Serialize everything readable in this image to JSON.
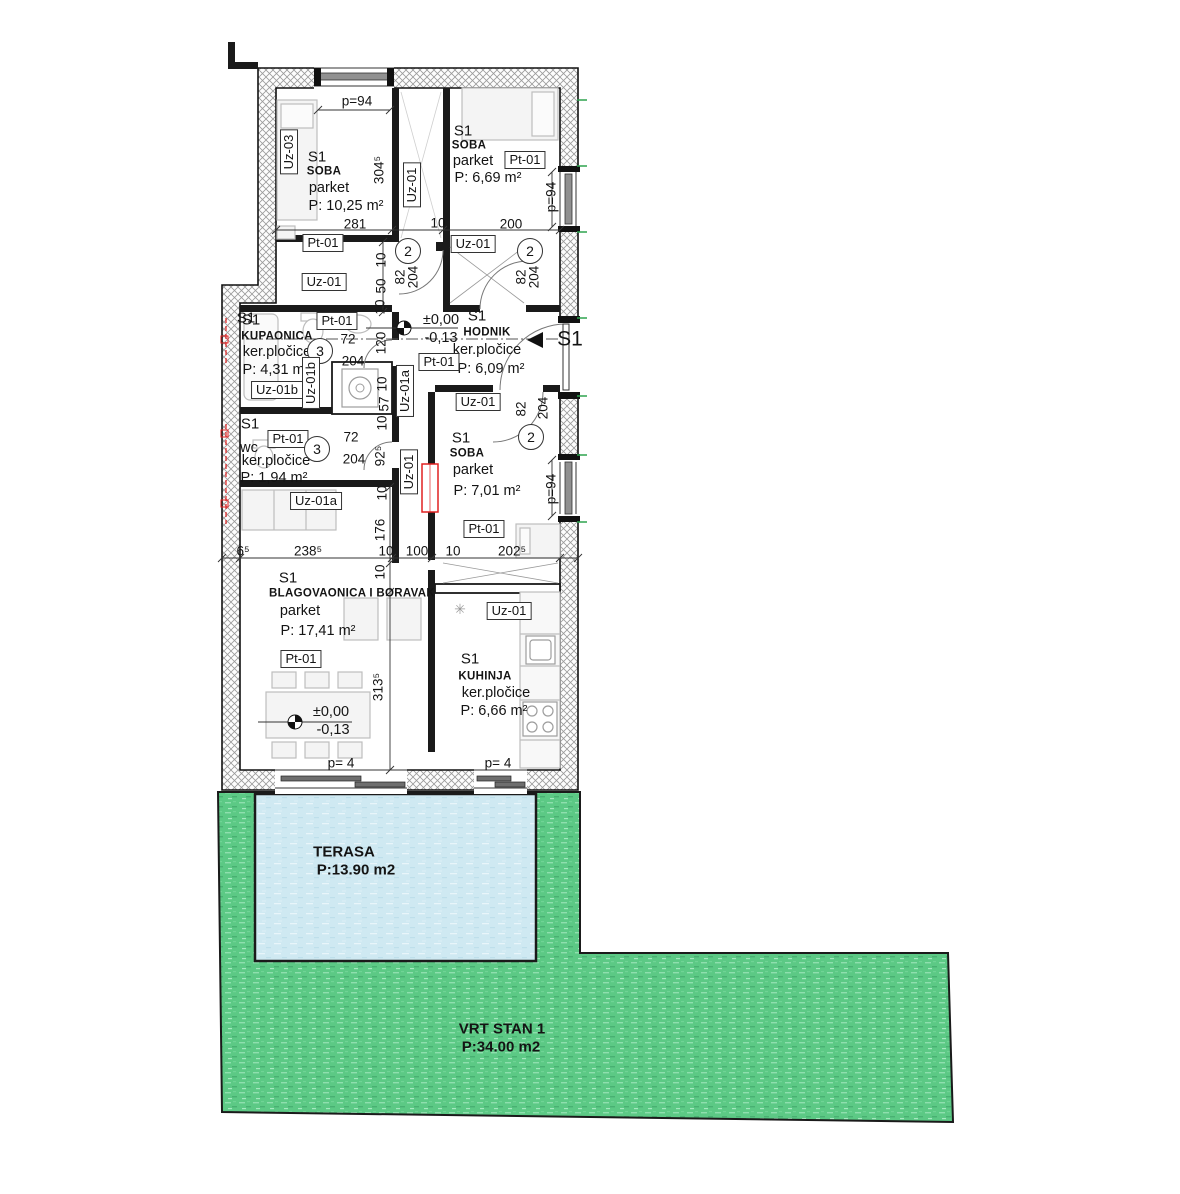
{
  "plan": {
    "drawing_title": "STAN 1 floor plan",
    "colors": {
      "garden": "#5cc985",
      "terrace": "#cfe9f2",
      "wall": "#141414",
      "accent_red": "#e02020",
      "accent_green": "#2ea44f"
    },
    "outdoor": {
      "terrace": {
        "name": "TERASA",
        "area": "P:13.90 m2"
      },
      "garden": {
        "name": "VRT STAN 1",
        "area": "P:34.00 m2"
      }
    },
    "labels": [
      {
        "n": "dim-p94-top",
        "t": "p=94",
        "x": 357,
        "y": 101,
        "c": "dim"
      },
      {
        "n": "tag-uz03",
        "t": "Uz-03",
        "x": 289,
        "y": 152,
        "c": "tag v"
      },
      {
        "n": "room1-id",
        "t": "S1",
        "x": 317,
        "y": 157,
        "c": "rid"
      },
      {
        "n": "room1-name",
        "t": "SOBA",
        "x": 324,
        "y": 172,
        "c": "rname"
      },
      {
        "n": "room1-floor",
        "t": "parket",
        "x": 329,
        "y": 188,
        "c": "rsub"
      },
      {
        "n": "room1-area",
        "t": "P: 10,25 m²",
        "x": 346,
        "y": 206,
        "c": "area"
      },
      {
        "n": "dim-304",
        "t": "304⁵",
        "x": 379,
        "y": 170,
        "c": "dim v"
      },
      {
        "n": "dim-281",
        "t": "281",
        "x": 355,
        "y": 224,
        "c": "dim"
      },
      {
        "n": "tag-pt01-a",
        "t": "Pt-01",
        "x": 323,
        "y": 243,
        "c": "tag"
      },
      {
        "n": "tag-uz01-a",
        "t": "Uz-01",
        "x": 324,
        "y": 282,
        "c": "tag"
      },
      {
        "n": "tag-uz01-closet",
        "t": "Uz-01",
        "x": 412,
        "y": 185,
        "c": "tag v"
      },
      {
        "n": "room2-id",
        "t": "S1",
        "x": 463,
        "y": 131,
        "c": "rid"
      },
      {
        "n": "room2-name",
        "t": "SOBA",
        "x": 469,
        "y": 146,
        "c": "rname"
      },
      {
        "n": "room2-floor",
        "t": "parket",
        "x": 473,
        "y": 161,
        "c": "rsub"
      },
      {
        "n": "room2-area",
        "t": "P: 6,69 m²",
        "x": 488,
        "y": 178,
        "c": "area"
      },
      {
        "n": "tag-pt01-b",
        "t": "Pt-01",
        "x": 525,
        "y": 160,
        "c": "tag"
      },
      {
        "n": "dim-p94-r1",
        "t": "p=94",
        "x": 551,
        "y": 197,
        "c": "dim v"
      },
      {
        "n": "dim-10-top",
        "t": "10",
        "x": 438,
        "y": 223,
        "c": "dim"
      },
      {
        "n": "dim-200",
        "t": "200",
        "x": 511,
        "y": 224,
        "c": "dim"
      },
      {
        "n": "circle-door-2a",
        "t": "2",
        "x": 408,
        "y": 251,
        "c": "circ"
      },
      {
        "n": "dim-82-a",
        "t": "82",
        "x": 400,
        "y": 277,
        "c": "dim v"
      },
      {
        "n": "dim-204-a",
        "t": "204",
        "x": 413,
        "y": 277,
        "c": "dim v"
      },
      {
        "n": "circle-door-2b",
        "t": "2",
        "x": 530,
        "y": 251,
        "c": "circ"
      },
      {
        "n": "dim-82-b",
        "t": "82",
        "x": 521,
        "y": 277,
        "c": "dim v"
      },
      {
        "n": "dim-204-b",
        "t": "204",
        "x": 534,
        "y": 277,
        "c": "dim v"
      },
      {
        "n": "dim-10-v1",
        "t": "10",
        "x": 381,
        "y": 260,
        "c": "dim v"
      },
      {
        "n": "dim-50",
        "t": "50",
        "x": 381,
        "y": 286,
        "c": "dim v"
      },
      {
        "n": "tag-uz01-b",
        "t": "Uz-01",
        "x": 473,
        "y": 244,
        "c": "tag"
      },
      {
        "n": "bath-id",
        "t": "S1",
        "x": 251,
        "y": 320,
        "c": "rid"
      },
      {
        "n": "bath-name",
        "t": "KUPAONICA",
        "x": 277,
        "y": 337,
        "c": "rname"
      },
      {
        "n": "bath-floor",
        "t": "ker.pločice",
        "x": 277,
        "y": 352,
        "c": "rsub"
      },
      {
        "n": "bath-area",
        "t": "P: 4,31 m²",
        "x": 276,
        "y": 370,
        "c": "area"
      },
      {
        "n": "tag-pt01-c",
        "t": "Pt-01",
        "x": 337,
        "y": 321,
        "c": "tag"
      },
      {
        "n": "circle-door-3a",
        "t": "3",
        "x": 320,
        "y": 351,
        "c": "circ"
      },
      {
        "n": "dim-72-a",
        "t": "72",
        "x": 348,
        "y": 339,
        "c": "dim"
      },
      {
        "n": "dim-204-c",
        "t": "204",
        "x": 353,
        "y": 361,
        "c": "dim"
      },
      {
        "n": "dim-120",
        "t": "120",
        "x": 381,
        "y": 343,
        "c": "dim v"
      },
      {
        "n": "tag-uz01b-h",
        "t": "Uz-01b",
        "x": 277,
        "y": 390,
        "c": "tag"
      },
      {
        "n": "tag-uz01b-v",
        "t": "Uz-01b",
        "x": 311,
        "y": 383,
        "c": "tag v"
      },
      {
        "n": "dim-10-v2",
        "t": "10",
        "x": 380,
        "y": 307,
        "c": "dim v"
      },
      {
        "n": "level1-top",
        "t": "±0,00",
        "x": 441,
        "y": 320,
        "c": "area"
      },
      {
        "n": "level1-bottom",
        "t": "-0,13",
        "x": 441,
        "y": 338,
        "c": "area"
      },
      {
        "n": "hall-id",
        "t": "S1",
        "x": 477,
        "y": 316,
        "c": "rid"
      },
      {
        "n": "hall-name",
        "t": "HODNIK",
        "x": 487,
        "y": 333,
        "c": "rname"
      },
      {
        "n": "hall-floor",
        "t": "ker.pločice",
        "x": 487,
        "y": 350,
        "c": "rsub"
      },
      {
        "n": "hall-area",
        "t": "P: 6,09 m²",
        "x": 491,
        "y": 369,
        "c": "area"
      },
      {
        "n": "tag-pt01-d",
        "t": "Pt-01",
        "x": 439,
        "y": 362,
        "c": "tag"
      },
      {
        "n": "section-marker-right",
        "t": "S1",
        "x": 570,
        "y": 339,
        "c": "big"
      },
      {
        "n": "section-marker-left",
        "t": "S1",
        "x": 246,
        "y": 318,
        "c": "rid"
      },
      {
        "n": "tag-uz01-c",
        "t": "Uz-01",
        "x": 478,
        "y": 402,
        "c": "tag"
      },
      {
        "n": "tag-uz01a-v",
        "t": "Uz-01a",
        "x": 405,
        "y": 391,
        "c": "tag v"
      },
      {
        "n": "dim-57",
        "t": "57",
        "x": 384,
        "y": 404,
        "c": "dim v"
      },
      {
        "n": "dim-10-v3",
        "t": "10",
        "x": 382,
        "y": 384,
        "c": "dim v"
      },
      {
        "n": "dim-10-v4",
        "t": "10",
        "x": 382,
        "y": 423,
        "c": "dim v"
      },
      {
        "n": "wc-id",
        "t": "S1",
        "x": 250,
        "y": 424,
        "c": "rid"
      },
      {
        "n": "wc-name",
        "t": "wc",
        "x": 249,
        "y": 448,
        "c": "rsub"
      },
      {
        "n": "wc-floor",
        "t": "ker.pločice",
        "x": 276,
        "y": 461,
        "c": "rsub"
      },
      {
        "n": "wc-area",
        "t": "P: 1,94 m²",
        "x": 274,
        "y": 478,
        "c": "area"
      },
      {
        "n": "tag-pt01-e",
        "t": "Pt-01",
        "x": 288,
        "y": 439,
        "c": "tag"
      },
      {
        "n": "circle-door-3b",
        "t": "3",
        "x": 317,
        "y": 449,
        "c": "circ"
      },
      {
        "n": "dim-72-b",
        "t": "72",
        "x": 351,
        "y": 437,
        "c": "dim"
      },
      {
        "n": "dim-204-d",
        "t": "204",
        "x": 354,
        "y": 459,
        "c": "dim"
      },
      {
        "n": "dim-92",
        "t": "92⁵",
        "x": 380,
        "y": 456,
        "c": "dim v"
      },
      {
        "n": "tag-uz01-corridor",
        "t": "Uz-01",
        "x": 409,
        "y": 472,
        "c": "tag v"
      },
      {
        "n": "circle-door-2c",
        "t": "2",
        "x": 531,
        "y": 437,
        "c": "circ"
      },
      {
        "n": "dim-82-c",
        "t": "82",
        "x": 521,
        "y": 409,
        "c": "dim v"
      },
      {
        "n": "dim-204-e",
        "t": "204",
        "x": 543,
        "y": 408,
        "c": "dim v"
      },
      {
        "n": "room3-id",
        "t": "S1",
        "x": 461,
        "y": 438,
        "c": "rid"
      },
      {
        "n": "room3-name",
        "t": "SOBA",
        "x": 467,
        "y": 454,
        "c": "rname"
      },
      {
        "n": "room3-floor",
        "t": "parket",
        "x": 473,
        "y": 470,
        "c": "rsub"
      },
      {
        "n": "room3-area",
        "t": "P: 7,01 m²",
        "x": 487,
        "y": 491,
        "c": "area"
      },
      {
        "n": "tag-pt01-f",
        "t": "Pt-01",
        "x": 484,
        "y": 529,
        "c": "tag"
      },
      {
        "n": "dim-p94-r2",
        "t": "p=94",
        "x": 551,
        "y": 489,
        "c": "dim v"
      },
      {
        "n": "tag-uz01a-h",
        "t": "Uz-01a",
        "x": 316,
        "y": 501,
        "c": "tag"
      },
      {
        "n": "dim-65",
        "t": "6⁵",
        "x": 243,
        "y": 551,
        "c": "dim"
      },
      {
        "n": "dim-238",
        "t": "238⁵",
        "x": 308,
        "y": 551,
        "c": "dim"
      },
      {
        "n": "dim-10-b",
        "t": "10",
        "x": 386,
        "y": 551,
        "c": "dim"
      },
      {
        "n": "dim-100",
        "t": "100",
        "x": 417,
        "y": 551,
        "c": "dim"
      },
      {
        "n": "dim-10-c",
        "t": "10",
        "x": 453,
        "y": 551,
        "c": "dim"
      },
      {
        "n": "dim-202",
        "t": "202⁵",
        "x": 512,
        "y": 551,
        "c": "dim"
      },
      {
        "n": "dim-176",
        "t": "176",
        "x": 380,
        "y": 530,
        "c": "dim v"
      },
      {
        "n": "dim-10-v5",
        "t": "10",
        "x": 382,
        "y": 493,
        "c": "dim v"
      },
      {
        "n": "dim-10-v6",
        "t": "10",
        "x": 380,
        "y": 572,
        "c": "dim v"
      },
      {
        "n": "living-id",
        "t": "S1",
        "x": 288,
        "y": 578,
        "c": "rid"
      },
      {
        "n": "living-name",
        "t": "BLAGOVAONICA I BORAVAK",
        "x": 352,
        "y": 594,
        "c": "rname"
      },
      {
        "n": "living-floor",
        "t": "parket",
        "x": 300,
        "y": 611,
        "c": "rsub"
      },
      {
        "n": "living-area",
        "t": "P: 17,41 m²",
        "x": 318,
        "y": 631,
        "c": "area"
      },
      {
        "n": "tag-pt01-g",
        "t": "Pt-01",
        "x": 301,
        "y": 659,
        "c": "tag"
      },
      {
        "n": "level2-top",
        "t": "±0,00",
        "x": 331,
        "y": 712,
        "c": "area"
      },
      {
        "n": "level2-bottom",
        "t": "-0,13",
        "x": 333,
        "y": 730,
        "c": "area"
      },
      {
        "n": "dim-313",
        "t": "313⁵",
        "x": 378,
        "y": 687,
        "c": "dim v"
      },
      {
        "n": "kitchen-id",
        "t": "S1",
        "x": 470,
        "y": 659,
        "c": "rid"
      },
      {
        "n": "kitchen-name",
        "t": "KUHINJA",
        "x": 485,
        "y": 677,
        "c": "rname"
      },
      {
        "n": "kitchen-floor",
        "t": "ker.pločice",
        "x": 496,
        "y": 693,
        "c": "rsub"
      },
      {
        "n": "kitchen-area",
        "t": "P: 6,66 m²",
        "x": 494,
        "y": 711,
        "c": "area"
      },
      {
        "n": "tag-uz01-d",
        "t": "Uz-01",
        "x": 509,
        "y": 611,
        "c": "tag"
      },
      {
        "n": "star-symbol",
        "t": "✳",
        "x": 460,
        "y": 609,
        "c": "sym"
      },
      {
        "n": "dim-p4-a",
        "t": "p= 4",
        "x": 341,
        "y": 763,
        "c": "dim"
      },
      {
        "n": "dim-p4-b",
        "t": "p= 4",
        "x": 498,
        "y": 763,
        "c": "dim"
      },
      {
        "n": "terrace-name",
        "t": "TERASA",
        "x": 344,
        "y": 852,
        "c": "tname"
      },
      {
        "n": "terrace-area",
        "t": "P:13.90 m2",
        "x": 356,
        "y": 870,
        "c": "tarea"
      },
      {
        "n": "garden-name",
        "t": "VRT STAN 1",
        "x": 502,
        "y": 1029,
        "c": "tname"
      },
      {
        "n": "garden-area",
        "t": "P:34.00 m2",
        "x": 501,
        "y": 1047,
        "c": "tarea"
      }
    ]
  }
}
